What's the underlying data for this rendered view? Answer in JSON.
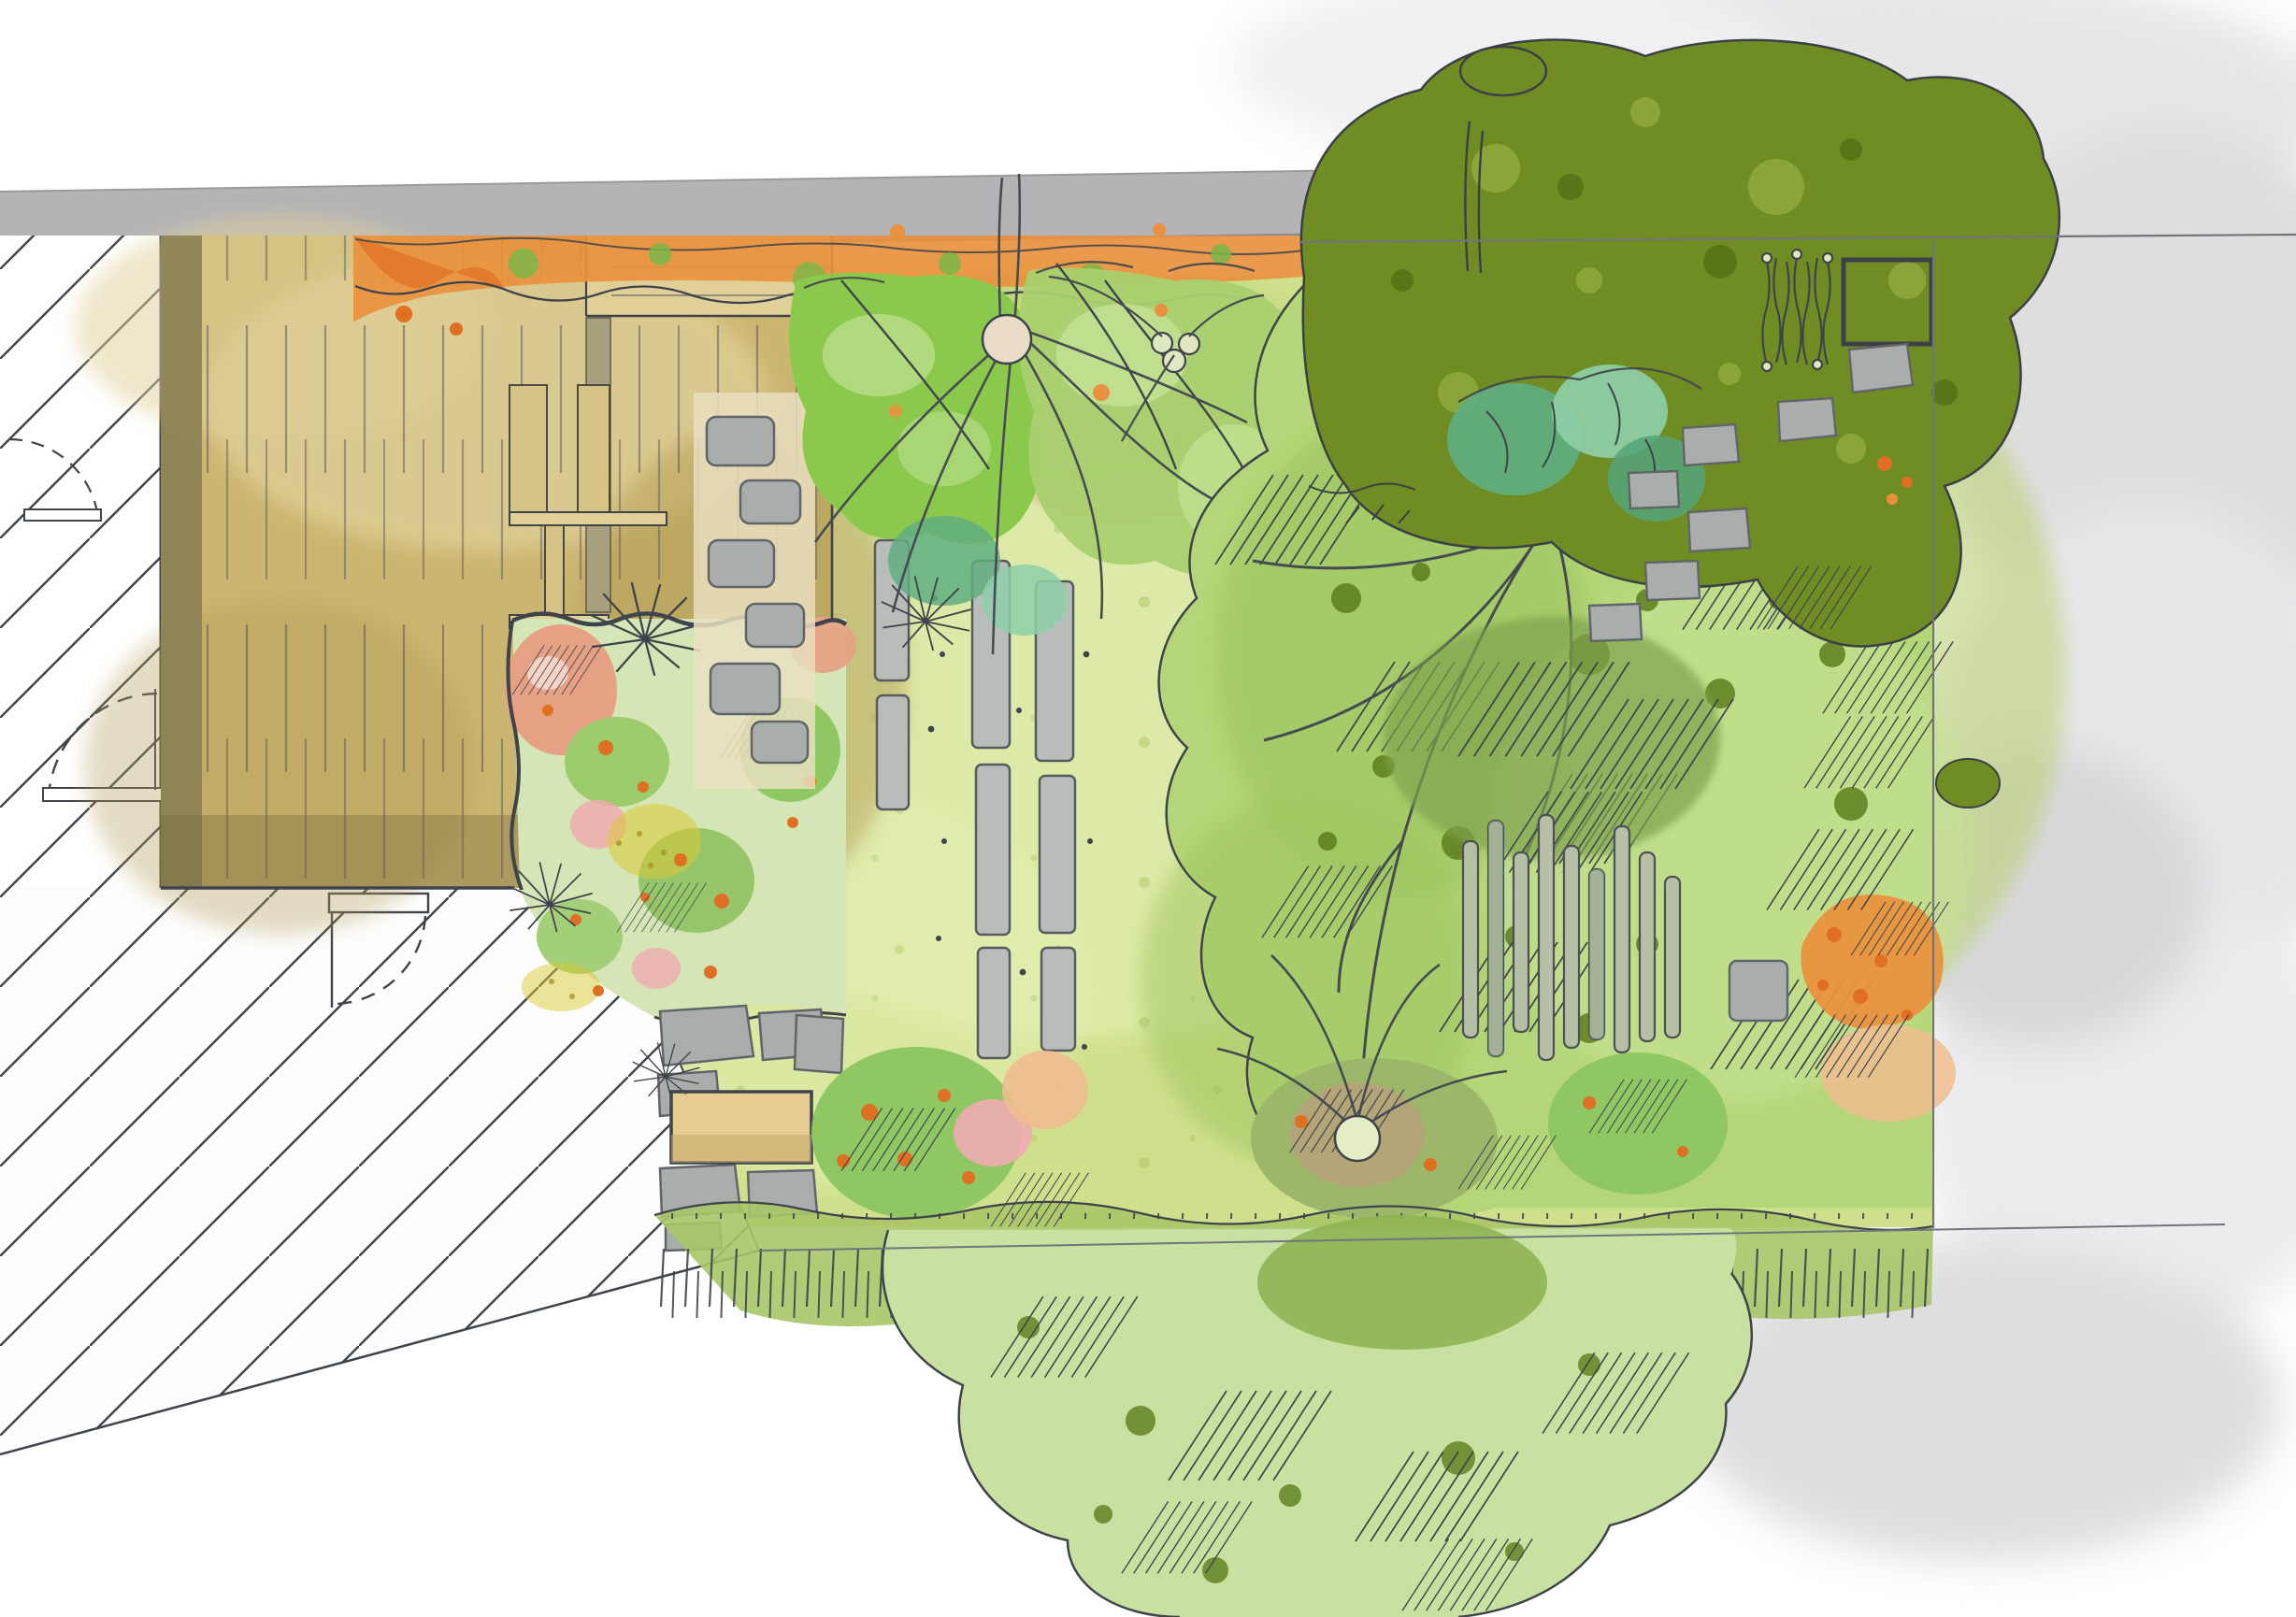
{
  "document": {
    "type": "garden-landscape-design-plan",
    "style": "hand-drawn watercolor and ink, top-down plan view",
    "description": "Watercolor garden design plan: house with hatched interior at left, timber deck with steps, planting bed with stepping stones, large lawn, ornamental trees with radiating branches, slat screens, stone paths, meadow fringe hedge and large tree canopies, boundary lines at top, right and bottom, soft grey watercolor clouds around the edges",
    "visible_text": "none"
  },
  "colors": {
    "ink": "#3f444b",
    "roof_gray": "#b4b4b6",
    "paper": "#ffffff",
    "deck_tan": "#cbb671",
    "deck_light": "#e0d098",
    "deck_dark": "#b19c55",
    "deck_shadow": "#857c52",
    "lawn": "#cfe08c",
    "lawn_light": "#e2eeb0",
    "lawn_mid": "#b8d06e",
    "shrub_bright": "#8bc94d",
    "shrub_light": "#b5dc85",
    "shrub_mid": "#a9d06f",
    "canopy": "#b5d678",
    "canopy_patch": "#9cc45e",
    "canopy_pale": "#c6e193",
    "canopy_spot": "#5e7e1d",
    "olive": "#6f8d22",
    "olive_light": "#8aa63a",
    "olive_dark": "#5a7517",
    "teal": "#5fae80",
    "teal_light": "#8ecfa8",
    "orange": "#e9913e",
    "orange_deep": "#df6f22",
    "salmon": "#e6a184",
    "salmon_pale": "#f6d3c4",
    "pink": "#f0abb0",
    "peach": "#f0bd8f",
    "yellow": "#d9c934",
    "yellow_dark": "#a98f1f",
    "stone": "#a9adab",
    "stone_dark": "#60656a",
    "slat": "#b5c0a6",
    "slat_dark": "#9aa98e",
    "table": "#e5cb90",
    "cloud": "#e7e7ea",
    "cloud2": "#dededf",
    "hedge": "#a8c668",
    "btree": "#c8e0a0",
    "btree_dark": "#8fb453",
    "line_gray": "#70757b"
  },
  "regions": [
    {
      "name": "roof-strip",
      "label": "grey roof overhang of house along top edge"
    },
    {
      "name": "house-interior-hatch",
      "label": "hatched house interior / side passage at left"
    },
    {
      "name": "door-swing-arcs",
      "label": "dashed door swing arcs with thresholds"
    },
    {
      "name": "timber-deck",
      "label": "tan timber deck with plank lines and steps"
    },
    {
      "name": "climber-vine-strip",
      "label": "orange flowering climber along top boundary"
    },
    {
      "name": "flower-bed",
      "label": "mixed planting bed with salmon, pink and yellow flowers"
    },
    {
      "name": "stepping-stone-path",
      "label": "grey stepping stones crossing deck and bed"
    },
    {
      "name": "patio-stones-table",
      "label": "small stone patio with tan table"
    },
    {
      "name": "lawn",
      "label": "large yellow-green lawn"
    },
    {
      "name": "plank-pavers-path",
      "label": "long grey timber pavers set into lawn"
    },
    {
      "name": "ornamental-tree",
      "label": "small multi-stem tree with radiating branches"
    },
    {
      "name": "shrub-border-top",
      "label": "green shrub border along top of lawn"
    },
    {
      "name": "large-tree-canopy",
      "label": "large light-green tree canopy with hatched shading"
    },
    {
      "name": "olive-tree-canopy",
      "label": "dark olive tree canopy top right"
    },
    {
      "name": "teal-perennials",
      "label": "teal leafy perennials"
    },
    {
      "name": "slat-screen-fence",
      "label": "vertical timber slat screen"
    },
    {
      "name": "squiggle-screen",
      "label": "wavy vertical rod screen, top right"
    },
    {
      "name": "timber-frame-square",
      "label": "square timber frame feature, top right"
    },
    {
      "name": "stone-path-right",
      "label": "stepping stone path on right side"
    },
    {
      "name": "orange-flower-drift",
      "label": "orange flower drift at right boundary"
    },
    {
      "name": "meadow-fringe-hedge",
      "label": "grassy meadow fringe along bottom of lawn"
    },
    {
      "name": "bottom-tree-canopy",
      "label": "large tree canopy overhanging bottom boundary"
    },
    {
      "name": "boundary-lines",
      "label": "thin survey boundary lines top, right and bottom"
    },
    {
      "name": "watercolor-clouds",
      "label": "soft grey watercolor clouds around plan edges"
    }
  ]
}
